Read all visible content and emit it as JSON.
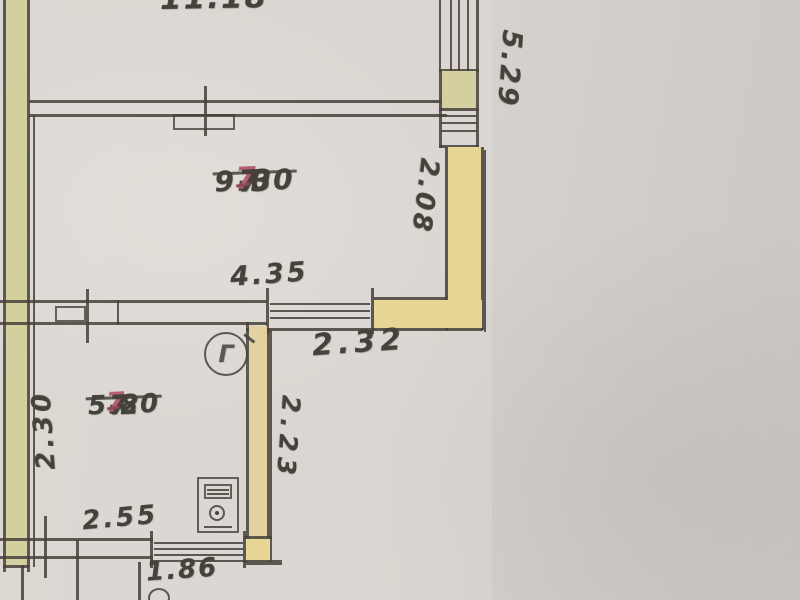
{
  "rooms": {
    "r73": {
      "number": "7",
      "suffix": "-3",
      "area": "9.00"
    },
    "r72": {
      "number": "7",
      "suffix": "-2",
      "area": "5.80"
    }
  },
  "dimensions": {
    "top_area": "11.18",
    "right_height": "5.29",
    "right_upper": "2.08",
    "r73_width": "4.35",
    "passage": "2.32",
    "r72_height": "2.30",
    "r72_right_height": "2.23",
    "r72_width": "2.55",
    "porch": "1.86"
  },
  "symbols": {
    "gas": "Г"
  },
  "colors": {
    "paper": "#d6d2cd",
    "ink": "#45413b",
    "red_ink": "#b4606e",
    "wall_green": "#d3cf9e",
    "wall_yellow": "#e6d595",
    "wall_red_edge": "#c4827f"
  }
}
